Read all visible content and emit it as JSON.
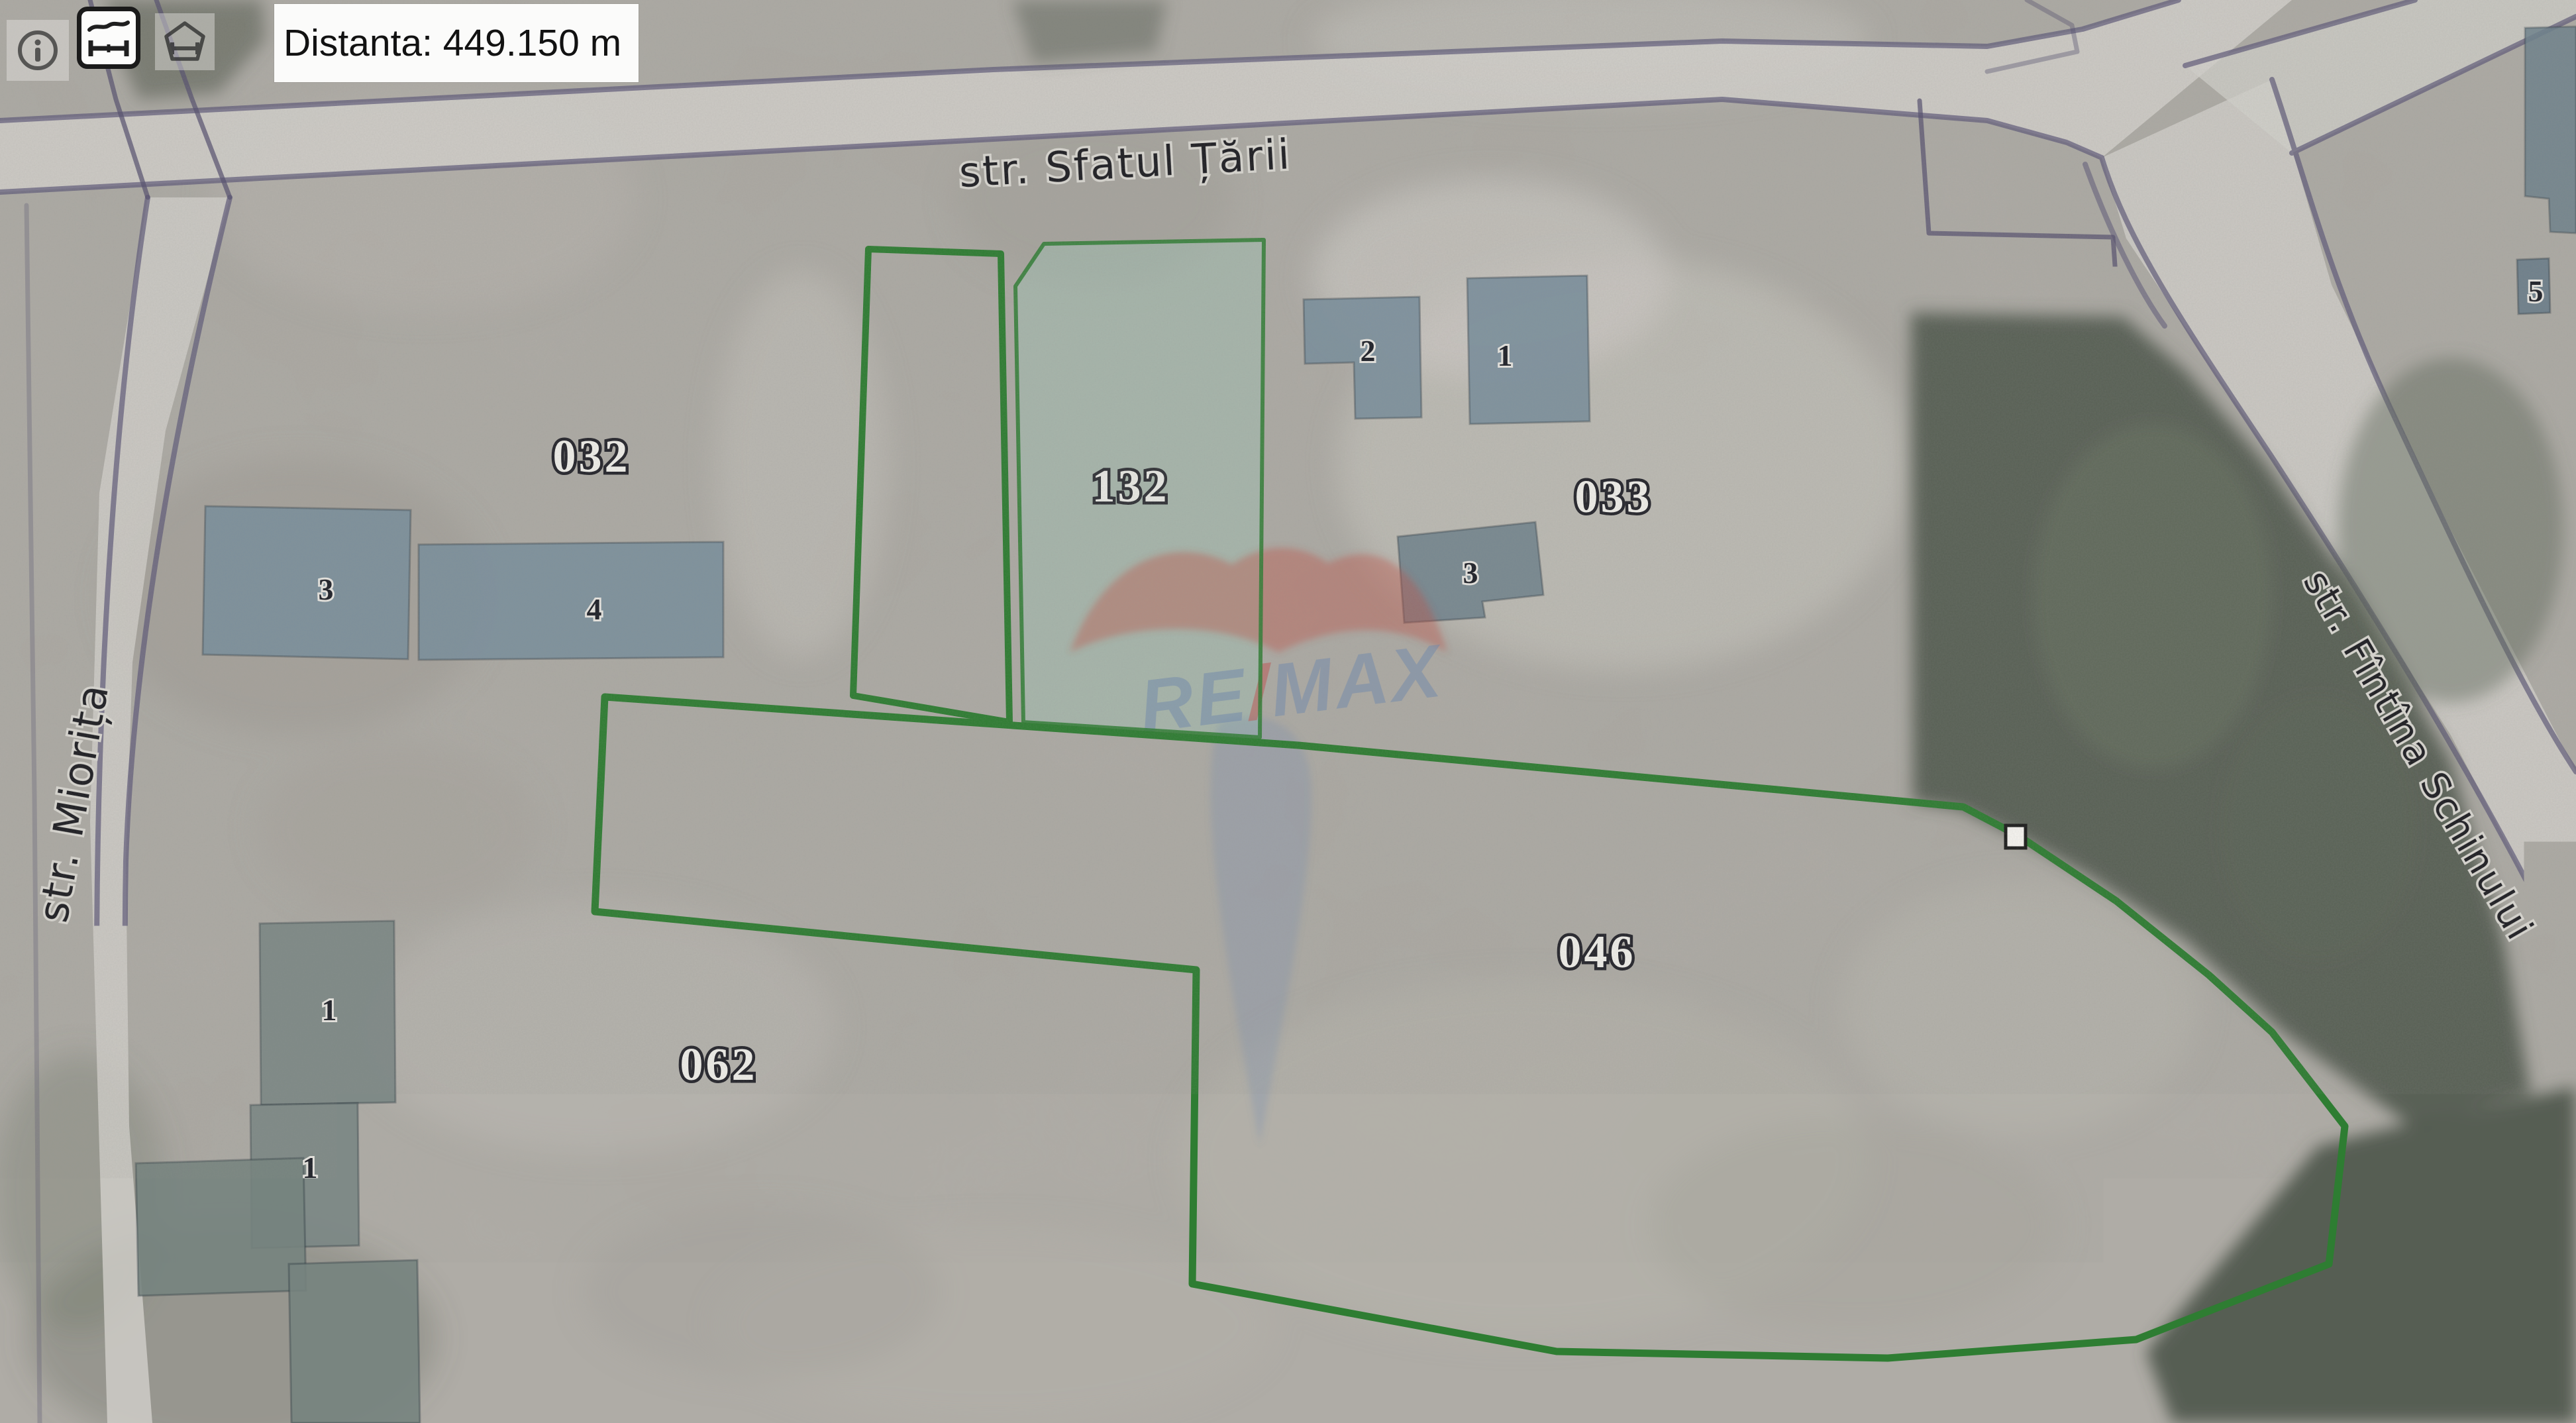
{
  "toolbar": {
    "distance_label": "Distanta: 449.150 m",
    "tools": [
      {
        "name": "info-icon"
      },
      {
        "name": "distance-measure-icon",
        "active": true
      },
      {
        "name": "area-measure-icon"
      }
    ]
  },
  "streets": {
    "sfatul_tarii": "str. Sfatul Țării",
    "miorita": "str. Miorița",
    "fintina_schinului": "str. Fîntîna Schinului"
  },
  "parcel_labels": {
    "p032": "032",
    "p132": "132",
    "p033": "033",
    "p046": "046",
    "p062": "062"
  },
  "building_labels": {
    "b032_3": "3",
    "b032_4": "4",
    "b033_2": "2",
    "b033_1": "1",
    "b033_3": "3",
    "left_1a": "1",
    "left_1b": "1",
    "left_2": "2",
    "left_1c": "1",
    "tr_5": "5"
  },
  "watermark": {
    "re": "RE",
    "slash": "/",
    "max": "MAX"
  },
  "colors": {
    "parcel_outline_green": "#2e7d32",
    "parcel_132_fill": "#9fc4b4",
    "cadastral_line": "#55506f",
    "road_edge": "#5d5878",
    "road_fill": "#d2d0cb",
    "building_fill": "#7b909d",
    "building_fill_muted": "#7a8784",
    "vegetation_dark": "#4f564b",
    "marker_fill": "#f7f5f1",
    "measure_label_bg": "#fbfbfa"
  }
}
